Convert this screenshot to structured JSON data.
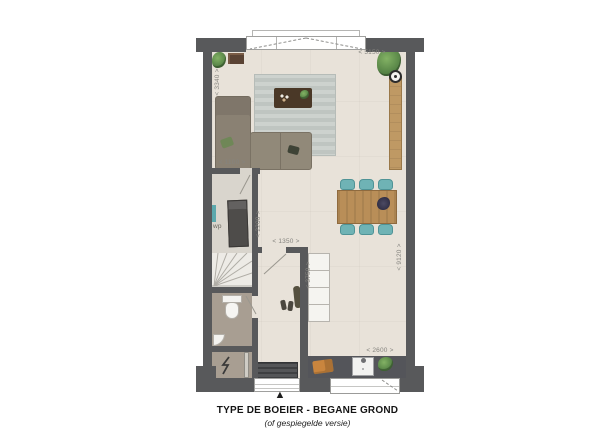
{
  "title": {
    "main": "TYPE DE BOEIER - BEGANE GROND",
    "sub": "(of gespiegelde versie)"
  },
  "dims": {
    "width_top": "< 5150 >",
    "living_depth": "< 3340 >",
    "closet_width": "< 1100 >",
    "closet_depth": "< 2200 >",
    "hall_width": "< 1350 >",
    "kitchen_depth": "< 3750 >",
    "house_depth": "< 9120 >",
    "kitchen_width": "< 2600 >"
  },
  "rooms": {
    "utility_label": "wp"
  },
  "markers": {
    "entrance_arrow": "▲"
  },
  "colors": {
    "wall": "#58595b",
    "floor": "#e8e2d9",
    "wet_floor": "#a89e92",
    "rug": "#c8cdc9",
    "sofa": "#8a8173",
    "wood": "#b98e58",
    "chair_teal": "#6fb3b5",
    "counter": "#54555a"
  }
}
